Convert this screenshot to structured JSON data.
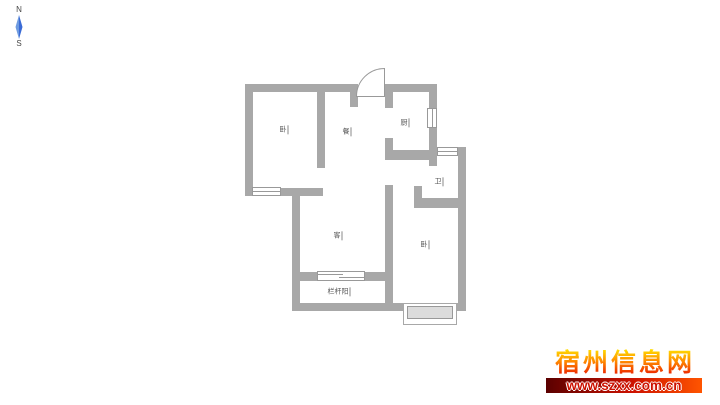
{
  "compass": {
    "north": "N",
    "south": "S",
    "needle_color": "#3a6bd6"
  },
  "floor_plan": {
    "wall_color": "#a8a8a8",
    "label_color": "#555555",
    "rooms": [
      {
        "name": "bedroom-top-left",
        "label": "卧"
      },
      {
        "name": "dining",
        "label": "餐"
      },
      {
        "name": "kitchen",
        "label": "厨"
      },
      {
        "name": "bathroom",
        "label": "卫"
      },
      {
        "name": "living",
        "label": "客"
      },
      {
        "name": "bedroom-bottom-right",
        "label": "卧"
      },
      {
        "name": "balcony",
        "label": "栏杆阳"
      }
    ]
  },
  "watermark": {
    "site_name": "宿州信息网",
    "site_url": "www.szxx.com.cn",
    "name_gradient_top": "#ffe000",
    "name_gradient_bottom": "#e81000",
    "bar_gradient_left": "#5a0000",
    "bar_gradient_right": "#ff5500",
    "url_text_color": "#cc1100"
  }
}
